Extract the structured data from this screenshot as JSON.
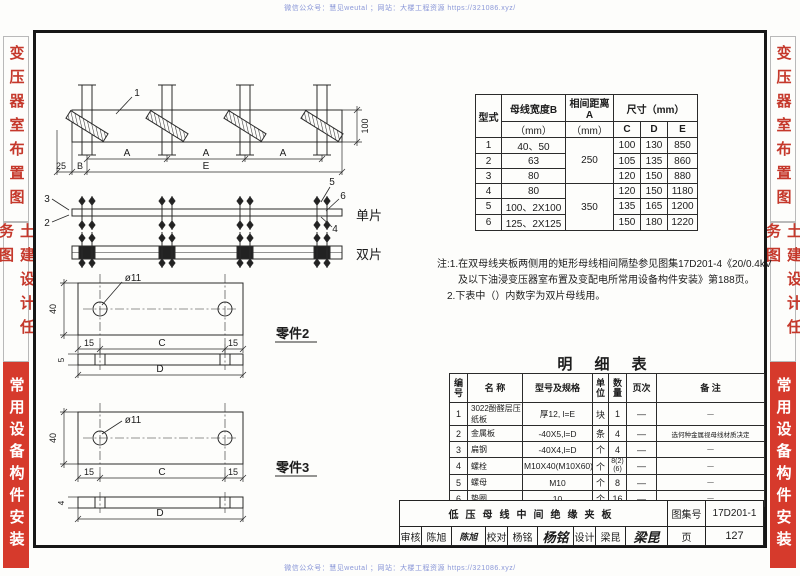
{
  "colors": {
    "accent_red": "#d63a2c",
    "red_text": "#c5382b",
    "watermark_blue": "#8a97d8",
    "frame_black": "#161616"
  },
  "watermark": {
    "text": "微信公众号：慧见weutal ；网站：大楼工程资源 https://321086.xyz/"
  },
  "sidebar": {
    "sections": [
      {
        "label": "变压器室布置图"
      },
      {
        "label": "土建设计任务图"
      },
      {
        "label": "常用设备构件安装"
      }
    ]
  },
  "drawing": {
    "callout1": "1",
    "callout2": "2",
    "callout3": "3",
    "callout4": "4",
    "callout5": "5",
    "callout6": "6",
    "dim_a": "A",
    "dim_b": "B",
    "dim_e": "E",
    "dim_25": "25",
    "dim_100": "100",
    "single": "单片",
    "double": "双片",
    "part2_title": "零件2",
    "part3_title": "零件3",
    "hole": "ø11",
    "dim_40": "40",
    "dim_15": "15",
    "dim_c": "C",
    "dim_d": "D",
    "dim_5": "5",
    "dim_4": "4"
  },
  "spec_table": {
    "h_type": "型式",
    "h_width1": "母线宽度B",
    "h_width2": "（mm）",
    "h_gap1": "相间距离A",
    "h_gap2": "（mm）",
    "h_size": "尺寸（mm）",
    "h_c": "C",
    "h_d": "D",
    "h_e": "E",
    "gap1": "250",
    "gap2": "350",
    "rows": [
      {
        "t": "1",
        "w": "40、50",
        "c": "100",
        "d": "130",
        "e": "850"
      },
      {
        "t": "2",
        "w": "63",
        "c": "105",
        "d": "135",
        "e": "860"
      },
      {
        "t": "3",
        "w": "80",
        "c": "120",
        "d": "150",
        "e": "880"
      },
      {
        "t": "4",
        "w": "80",
        "c": "120",
        "d": "150",
        "e": "1180"
      },
      {
        "t": "5",
        "w": "100、2X100",
        "c": "135",
        "d": "165",
        "e": "1200"
      },
      {
        "t": "6",
        "w": "125、2X125",
        "c": "150",
        "d": "180",
        "e": "1220"
      }
    ]
  },
  "notes": {
    "line1": "注:1.在双母线夹板两侧用的矩形母线相间隔垫参见图集17D201-4《20/0.4kV",
    "line2": "及以下油浸变压器室布置及变配电所常用设备构件安装》第188页。",
    "line3": "2.下表中（）内数字为双片母线用。"
  },
  "bom": {
    "title": "明 细 表",
    "headers": [
      "编号",
      "名 称",
      "型号及规格",
      "单位",
      "数量",
      "页次",
      "备 注"
    ],
    "rows": [
      [
        "1",
        "3022酚醛层压纸板",
        "厚12, l=E",
        "块",
        "1",
        "—",
        "—"
      ],
      [
        "2",
        "金属板",
        "-40X5,l=D",
        "条",
        "4",
        "—",
        "选何种金属视母线材质决定"
      ],
      [
        "3",
        "扁钢",
        "-40X4,l=D",
        "个",
        "4",
        "—",
        "—"
      ],
      [
        "4",
        "螺栓",
        "M10X40(M10X60)",
        "个",
        "8(2)(6)",
        "—",
        "—"
      ],
      [
        "5",
        "螺母",
        "M10",
        "个",
        "8",
        "—",
        "—"
      ],
      [
        "6",
        "垫圈",
        "10",
        "个",
        "16",
        "—",
        "—"
      ]
    ]
  },
  "title_block": {
    "title": "低压母线中间绝缘夹板",
    "atlas_label": "图集号",
    "atlas_no": "17D201-1",
    "page_label": "页",
    "page_no": "127",
    "check_label": "审核",
    "check_name": "陈旭",
    "check_sign": "陈旭",
    "proof_label": "校对",
    "proof_name": "杨铭",
    "proof_sign": "杨铭",
    "design_label": "设计",
    "design_name": "梁昆",
    "design_sign": "梁昆"
  }
}
